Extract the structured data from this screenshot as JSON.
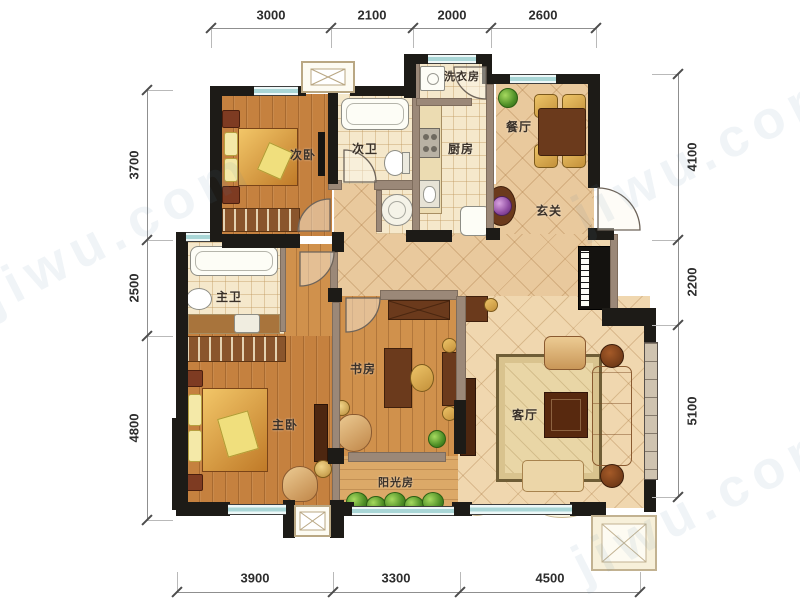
{
  "rooms": {
    "ci_wo": "次卧",
    "ci_wei": "次卫",
    "xi_yi_fang": "洗衣房",
    "chu_fang": "厨房",
    "can_ting": "餐厅",
    "xuan_guan": "玄关",
    "zhu_wei": "主卫",
    "zhu_wo": "主卧",
    "shu_fang": "书房",
    "yang_guang_fang": "阳光房",
    "ke_ting": "客厅"
  },
  "dims": {
    "top": [
      "3000",
      "2100",
      "2000",
      "2600"
    ],
    "bottom": [
      "3900",
      "3300",
      "4500"
    ],
    "left": [
      "3700",
      "2500",
      "4800"
    ],
    "right": [
      "4100",
      "2200",
      "5100"
    ]
  },
  "watermark": "jiwu.com",
  "colors": {
    "wall": "#1d1b17",
    "partition": "#9b8878",
    "window_glass": "#a9d6d6",
    "wood_floor": "#c5813f",
    "tile_floor": "#f5e8cb",
    "hall_tile": "#e9c99d",
    "sofa": "#d9b07a"
  }
}
